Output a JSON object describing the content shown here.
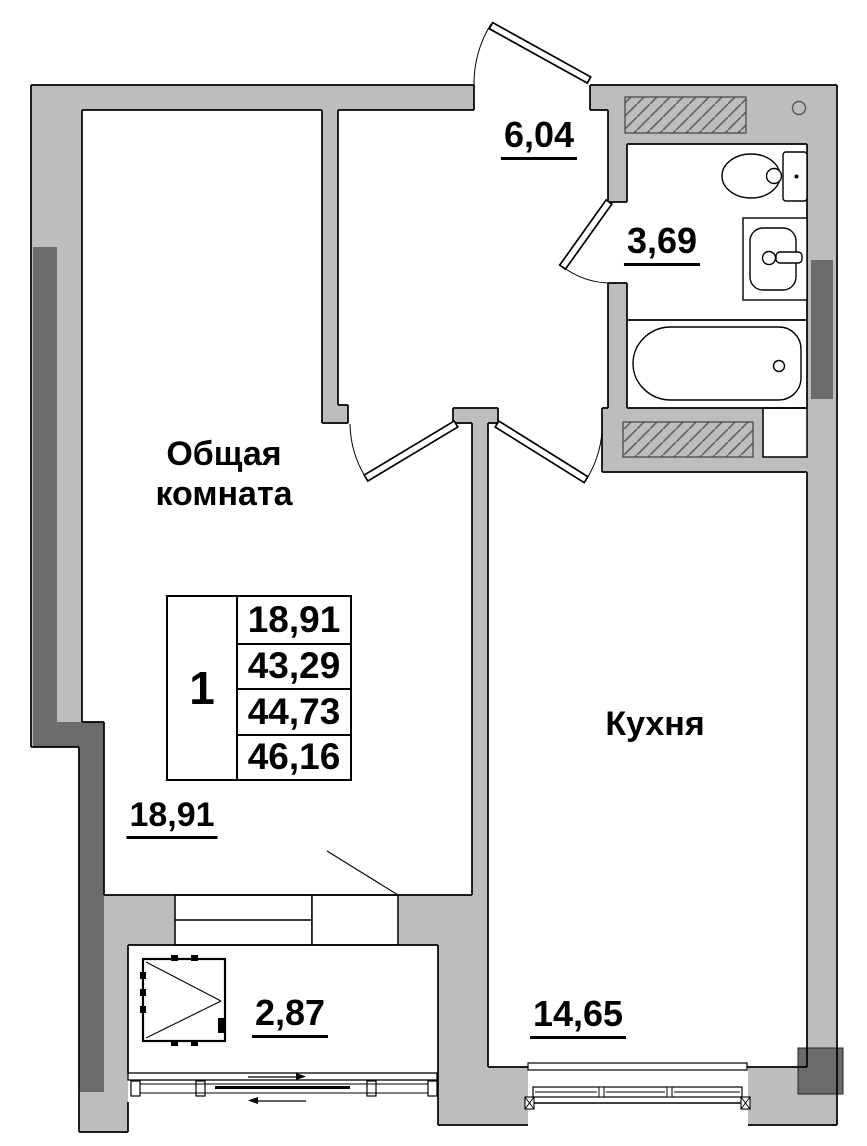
{
  "rooms": {
    "living": {
      "name_line1": "Общая",
      "name_line2": "комната",
      "area": "18,91"
    },
    "kitchen": {
      "name": "Кухня",
      "area": "14,65"
    },
    "hallway": {
      "area": "6,04"
    },
    "bathroom": {
      "area": "3,69"
    },
    "balcony": {
      "area": "2,87"
    }
  },
  "info_table": {
    "rooms_count": "1",
    "values": [
      "18,91",
      "43,29",
      "44,73",
      "46,16"
    ]
  },
  "colors": {
    "wall": "#bdbdbd",
    "pillar": "#6b6b6b",
    "outline": "#000000",
    "vent_border": "#4a4a4a"
  },
  "icons": [
    "toilet-icon",
    "sink-icon",
    "bathtub-icon",
    "casement-window-icon",
    "vent-shaft-hatch",
    "door-swing-arc",
    "sliding-window",
    "pipe-riser-circle"
  ]
}
